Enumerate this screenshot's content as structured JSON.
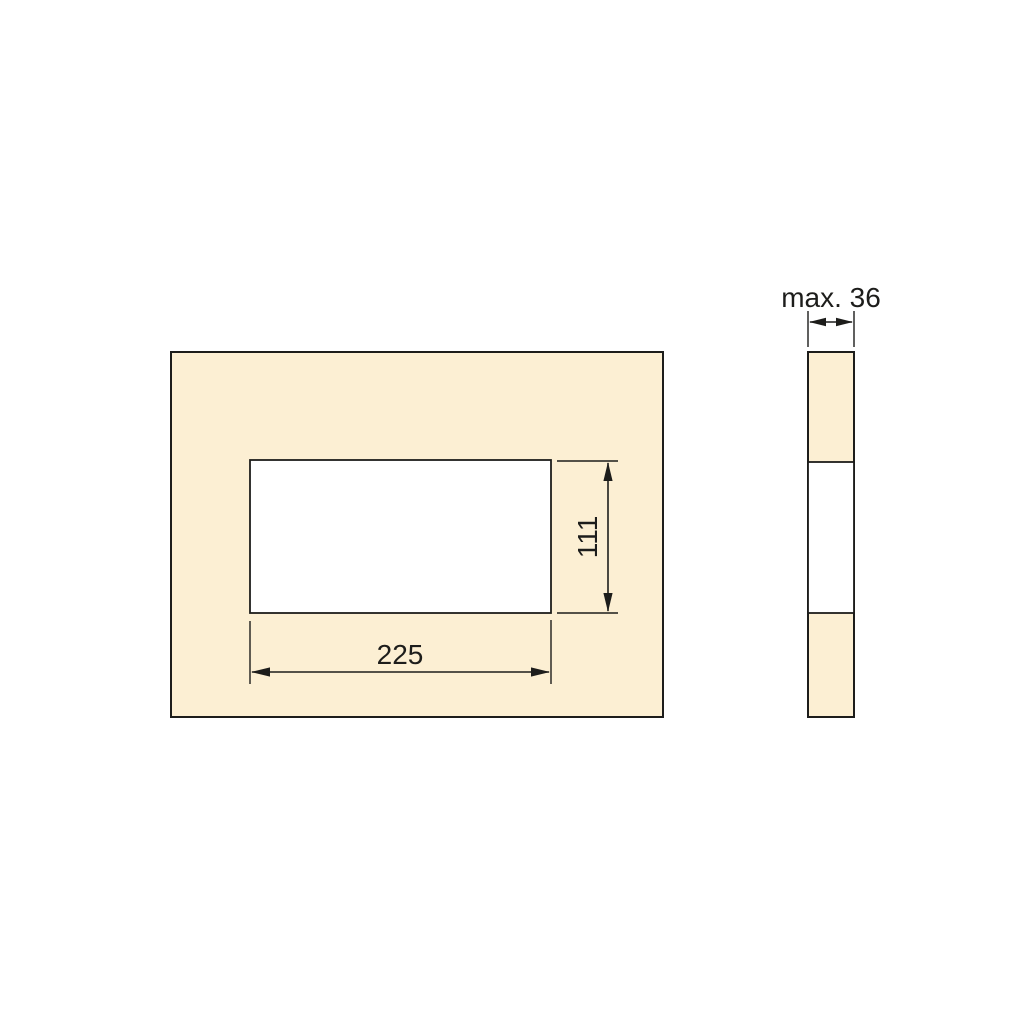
{
  "title": "Panel cutout technical drawing",
  "colors": {
    "background": "#ffffff",
    "panel_fill": "#fcefd3",
    "cutout_fill": "#ffffff",
    "line": "#1d1d1b"
  },
  "front_view": {
    "cutout_width_label": "225",
    "cutout_height_label": "111"
  },
  "side_view": {
    "thickness_label": "max. 36"
  },
  "values": {
    "cutout_width": 225,
    "cutout_height": 111,
    "max_panel_thickness": 36
  }
}
